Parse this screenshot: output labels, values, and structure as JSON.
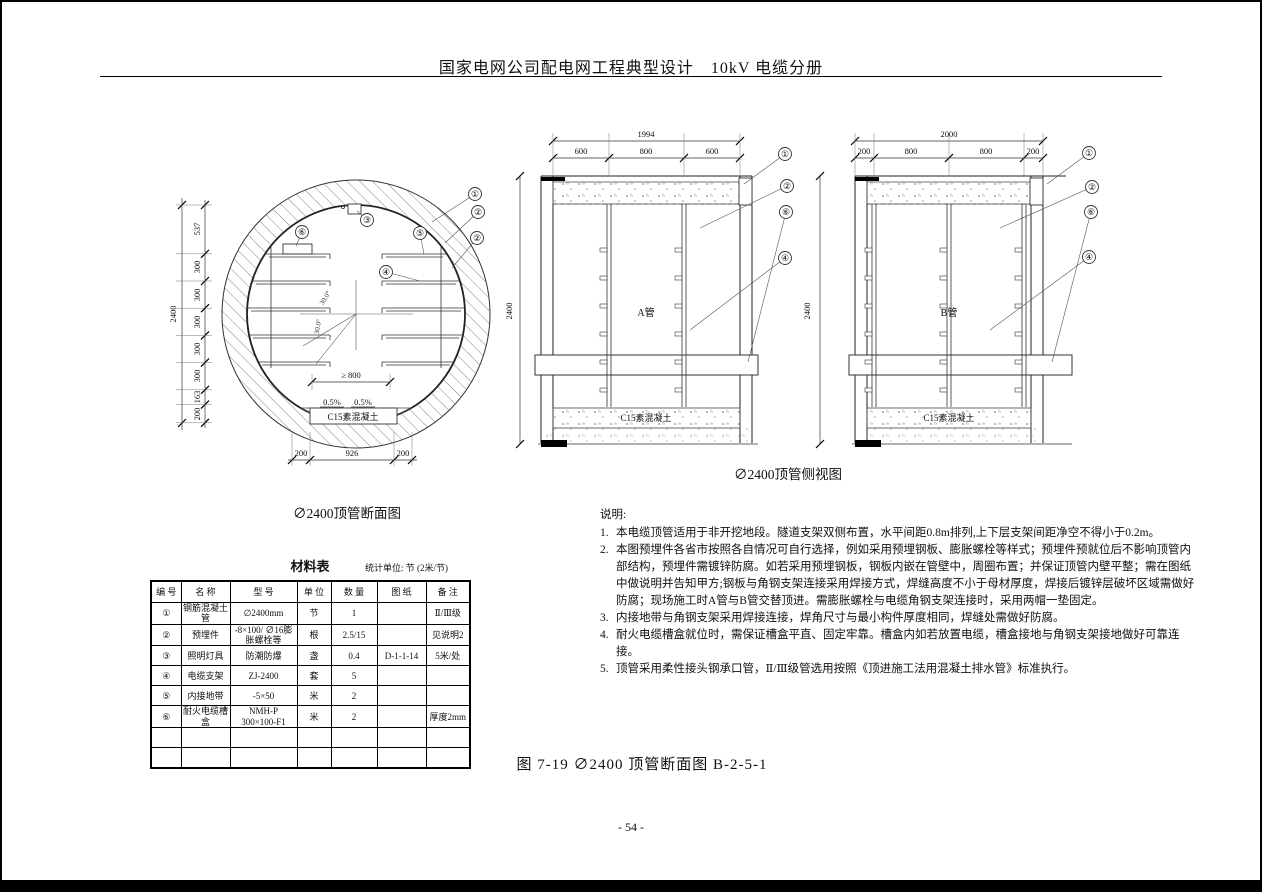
{
  "header": {
    "title": "国家电网公司配电网工程典型设计　10kV 电缆分册"
  },
  "cross_section": {
    "caption": "∅2400顶管断面图",
    "dim_total": "2400",
    "dims_left": [
      "537",
      "300",
      "300",
      "300",
      "300",
      "300",
      "163",
      "200"
    ],
    "dims_bottom": [
      "200",
      "926",
      "200"
    ],
    "dim_mid": "≥ 800",
    "slopes": [
      "0.5%",
      "0.5%"
    ],
    "angles": [
      "30.0°",
      "30.0°"
    ],
    "concrete_label": "C15素混凝土",
    "callouts": {
      "c1": "①",
      "c2a": "②",
      "c2b": "②",
      "c3": "③",
      "c4": "④",
      "c5": "⑤",
      "c6": "⑥"
    }
  },
  "side_view": {
    "caption": "∅2400顶管侧视图",
    "view_a": {
      "label": "A管",
      "dim_total": "1994",
      "dims": [
        "600",
        "800",
        "600"
      ],
      "dim_height": "2400",
      "concrete_label": "C15素混凝土",
      "callouts": [
        "①",
        "②",
        "⑥",
        "④"
      ]
    },
    "view_b": {
      "label": "B管",
      "dim_total": "2000",
      "dims": [
        "200",
        "800",
        "800",
        "200"
      ],
      "dim_height": "2400",
      "concrete_label": "C15素混凝土",
      "callouts": [
        "①",
        "②",
        "⑥",
        "④"
      ]
    }
  },
  "material_table": {
    "title": "材料表",
    "unit_note": "统计单位: 节 (2米/节)",
    "headers": [
      "编 号",
      "名 称",
      "型 号",
      "单 位",
      "数 量",
      "图 纸",
      "备 注"
    ],
    "rows": [
      [
        "①",
        "钢筋混凝土管",
        "∅2400mm",
        "节",
        "1",
        "",
        "Ⅱ/Ⅲ级"
      ],
      [
        "②",
        "预埋件",
        "-8×100/ ∅16膨胀螺栓等",
        "根",
        "2.5/15",
        "",
        "见说明2"
      ],
      [
        "③",
        "照明灯具",
        "防潮防爆",
        "盏",
        "0.4",
        "D-1-1-14",
        "5米/处"
      ],
      [
        "④",
        "电缆支架",
        "ZJ-2400",
        "套",
        "5",
        "",
        ""
      ],
      [
        "⑤",
        "内接地带",
        "-5×50",
        "米",
        "2",
        "",
        ""
      ],
      [
        "⑥",
        "耐火电缆槽盒",
        "NMH-P 300×100-F1",
        "米",
        "2",
        "",
        "厚度2mm"
      ],
      [
        "",
        "",
        "",
        "",
        "",
        "",
        ""
      ],
      [
        "",
        "",
        "",
        "",
        "",
        "",
        ""
      ]
    ]
  },
  "notes": {
    "title": "说明:",
    "items": [
      {
        "n": "1.",
        "t": "本电缆顶管适用于非开挖地段。隧道支架双侧布置，水平间距0.8m排列,上下层支架间距净空不得小于0.2m。"
      },
      {
        "n": "2.",
        "t": "本图预埋件各省市按照各自情况可自行选择，例如采用预埋钢板、膨胀螺栓等样式；预埋件预就位后不影响顶管内部结构，预埋件需镀锌防腐。如若采用预埋钢板，钢板内嵌在管壁中，周圈布置；并保证顶管内壁平整；需在图纸中做说明并告知甲方;钢板与角钢支架连接采用焊接方式，焊缝高度不小于母材厚度，焊接后镀锌层破坏区域需做好防腐；现场施工时A管与B管交替顶进。需膨胀螺栓与电缆角钢支架连接时，采用两帽一垫固定。"
      },
      {
        "n": "3.",
        "t": "内接地带与角钢支架采用焊接连接，焊角尺寸与最小构件厚度相同，焊缝处需做好防腐。"
      },
      {
        "n": "4.",
        "t": "耐火电缆槽盒就位时，需保证槽盒平直、固定牢靠。槽盒内如若放置电缆，槽盒接地与角钢支架接地做好可靠连接。"
      },
      {
        "n": "5.",
        "t": "顶管采用柔性接头钢承口管，Ⅱ/Ⅲ级管选用按照《顶进施工法用混凝土排水管》标准执行。"
      }
    ]
  },
  "figure_caption": "图 7-19 ∅2400 顶管断面图 B-2-5-1",
  "page_number": "- 54 -"
}
